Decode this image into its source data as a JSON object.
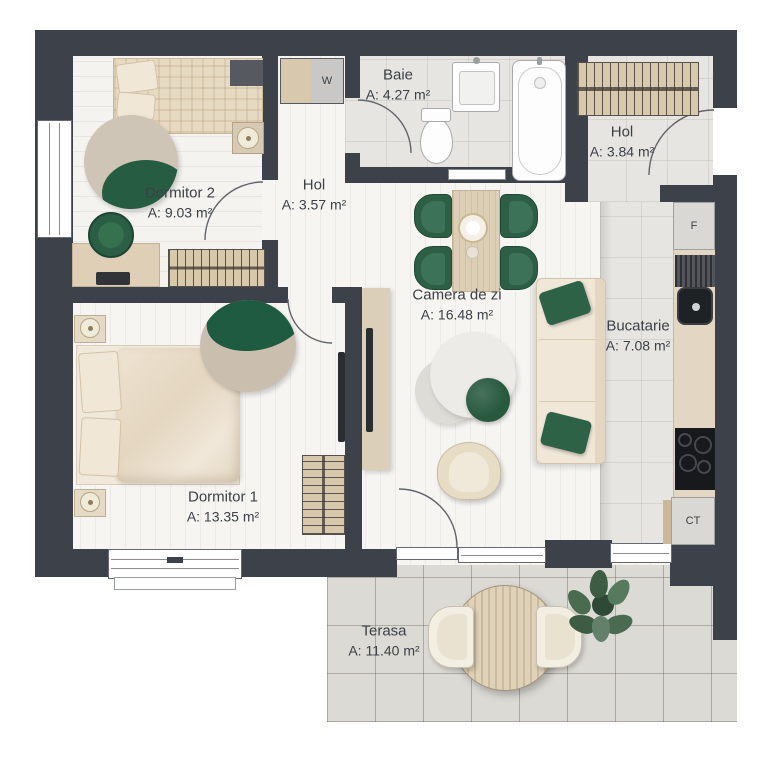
{
  "plan": {
    "rooms": [
      {
        "name": "Dormitor 2",
        "area": "A: 9.03 m²"
      },
      {
        "name": "Hol",
        "area": "A: 3.57 m²"
      },
      {
        "name": "Baie",
        "area": "A: 4.27 m²"
      },
      {
        "name": "Hol",
        "area": "A: 3.84 m²"
      },
      {
        "name": "Camera de zi",
        "area": "A: 16.48 m²"
      },
      {
        "name": "Bucatarie",
        "area": "A: 7.08 m²"
      },
      {
        "name": "Dormitor 1",
        "area": "A: 13.35 m²"
      },
      {
        "name": "Terasa",
        "area": "A: 11.40 m²"
      }
    ],
    "markers": {
      "wardrobe": "W",
      "fridge": "F",
      "heater": "CT"
    },
    "colors": {
      "wall": "#3d424a",
      "accent_green": "#275d44",
      "wood": "#ddcfb6",
      "floor": "#f6f5f2",
      "tile": "#e7e5e1",
      "terrace": "#dcdad4"
    }
  }
}
